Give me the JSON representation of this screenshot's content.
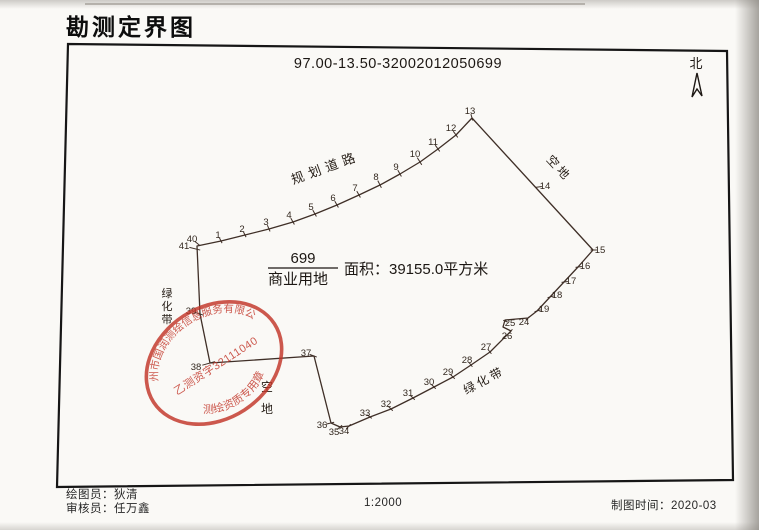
{
  "title": "勘测定界图",
  "map": {
    "code": "97.00-13.50-32002012050699",
    "north_label": "北",
    "parcel": {
      "number": "699",
      "land_use": "商业用地",
      "area_label": "面积：39155.0平方米"
    },
    "annotations": [
      {
        "name": "planned-road-label",
        "text": "规划道路",
        "x": 327,
        "y": 172,
        "rotate": -20,
        "spacing": 5,
        "size": 13
      },
      {
        "name": "vacant-land-label-right",
        "text": "空地",
        "x": 556,
        "y": 171,
        "rotate": 47,
        "spacing": 3,
        "size": 12
      },
      {
        "name": "green-belt-label-bottom",
        "text": "绿化带",
        "x": 486,
        "y": 384,
        "rotate": -28,
        "spacing": 3,
        "size": 12
      }
    ],
    "vertical_annotations": [
      {
        "name": "green-belt-label-left",
        "text": "绿化带",
        "x": 167,
        "y": 297,
        "dy": 13,
        "size": 11
      },
      {
        "name": "vacant-land-label-bottomleft",
        "text": "空地",
        "x": 267,
        "y": 391,
        "dy": 22,
        "size": 12
      }
    ],
    "outline": [
      [
        197,
        246
      ],
      [
        221,
        241
      ],
      [
        245,
        235
      ],
      [
        269,
        229
      ],
      [
        293,
        222
      ],
      [
        315,
        214
      ],
      [
        337,
        205
      ],
      [
        359,
        195
      ],
      [
        380,
        185
      ],
      [
        400,
        174
      ],
      [
        420,
        162
      ],
      [
        438,
        149
      ],
      [
        456,
        135
      ],
      [
        472,
        118
      ],
      [
        593,
        250
      ],
      [
        578,
        267
      ],
      [
        564,
        282
      ],
      [
        550,
        297
      ],
      [
        537,
        311
      ],
      [
        528,
        318
      ],
      [
        505,
        320
      ],
      [
        503,
        327
      ],
      [
        511,
        331
      ],
      [
        490,
        352
      ],
      [
        471,
        365
      ],
      [
        453,
        377
      ],
      [
        434,
        387
      ],
      [
        413,
        398
      ],
      [
        391,
        409
      ],
      [
        370,
        417
      ],
      [
        349,
        426
      ],
      [
        340,
        427
      ],
      [
        331,
        423
      ],
      [
        314,
        356
      ],
      [
        210,
        363
      ],
      [
        200,
        314
      ]
    ],
    "points": [
      {
        "n": "40",
        "vx": 198,
        "vy": 244,
        "lx": 192,
        "ly": 239
      },
      {
        "n": "41",
        "vx": 196,
        "vy": 249,
        "lx": 184,
        "ly": 246
      },
      {
        "n": "1",
        "vx": 221,
        "vy": 241,
        "lx": 218,
        "ly": 235
      },
      {
        "n": "2",
        "vx": 245,
        "vy": 235,
        "lx": 242,
        "ly": 229
      },
      {
        "n": "3",
        "vx": 269,
        "vy": 229,
        "lx": 266,
        "ly": 222
      },
      {
        "n": "4",
        "vx": 293,
        "vy": 222,
        "lx": 289,
        "ly": 215
      },
      {
        "n": "5",
        "vx": 315,
        "vy": 214,
        "lx": 311,
        "ly": 207
      },
      {
        "n": "6",
        "vx": 337,
        "vy": 205,
        "lx": 333,
        "ly": 198
      },
      {
        "n": "7",
        "vx": 359,
        "vy": 195,
        "lx": 355,
        "ly": 188
      },
      {
        "n": "8",
        "vx": 380,
        "vy": 185,
        "lx": 376,
        "ly": 177
      },
      {
        "n": "9",
        "vx": 400,
        "vy": 174,
        "lx": 396,
        "ly": 167
      },
      {
        "n": "10",
        "vx": 420,
        "vy": 162,
        "lx": 415,
        "ly": 154
      },
      {
        "n": "11",
        "vx": 438,
        "vy": 149,
        "lx": 433,
        "ly": 142
      },
      {
        "n": "12",
        "vx": 456,
        "vy": 135,
        "lx": 451,
        "ly": 128
      },
      {
        "n": "13",
        "vx": 472,
        "vy": 118,
        "lx": 470,
        "ly": 111
      },
      {
        "n": "14",
        "vx": 538,
        "vy": 187,
        "lx": 545,
        "ly": 186
      },
      {
        "n": "15",
        "vx": 593,
        "vy": 250,
        "lx": 600,
        "ly": 250
      },
      {
        "n": "16",
        "vx": 578,
        "vy": 267,
        "lx": 585,
        "ly": 266
      },
      {
        "n": "17",
        "vx": 564,
        "vy": 282,
        "lx": 571,
        "ly": 281
      },
      {
        "n": "18",
        "vx": 550,
        "vy": 297,
        "lx": 557,
        "ly": 295
      },
      {
        "n": "19",
        "vx": 537,
        "vy": 311,
        "lx": 544,
        "ly": 309
      },
      {
        "n": "24",
        "vx": 528,
        "vy": 318,
        "lx": 524,
        "ly": 322
      },
      {
        "n": "25",
        "vx": 505,
        "vy": 321,
        "lx": 510,
        "ly": 323
      },
      {
        "n": "26",
        "vx": 511,
        "vy": 331,
        "lx": 507,
        "ly": 336
      },
      {
        "n": "27",
        "vx": 490,
        "vy": 352,
        "lx": 486,
        "ly": 347
      },
      {
        "n": "28",
        "vx": 471,
        "vy": 365,
        "lx": 467,
        "ly": 360
      },
      {
        "n": "29",
        "vx": 453,
        "vy": 377,
        "lx": 448,
        "ly": 372
      },
      {
        "n": "30",
        "vx": 434,
        "vy": 387,
        "lx": 429,
        "ly": 382
      },
      {
        "n": "31",
        "vx": 413,
        "vy": 398,
        "lx": 408,
        "ly": 393
      },
      {
        "n": "32",
        "vx": 391,
        "vy": 409,
        "lx": 386,
        "ly": 404
      },
      {
        "n": "33",
        "vx": 370,
        "vy": 417,
        "lx": 365,
        "ly": 413
      },
      {
        "n": "34",
        "vx": 349,
        "vy": 426,
        "lx": 344,
        "ly": 431
      },
      {
        "n": "35",
        "vx": 340,
        "vy": 427,
        "lx": 334,
        "ly": 432
      },
      {
        "n": "36",
        "vx": 331,
        "vy": 423,
        "lx": 322,
        "ly": 425
      },
      {
        "n": "37",
        "vx": 314,
        "vy": 356,
        "lx": 306,
        "ly": 353
      },
      {
        "n": "38",
        "vx": 210,
        "vy": 363,
        "lx": 196,
        "ly": 367
      },
      {
        "n": "39",
        "vx": 200,
        "vy": 314,
        "lx": 191,
        "ly": 311
      }
    ],
    "line_color": "#3f2f27",
    "label_color": "#33281f"
  },
  "stamp": {
    "line1": "徐州市国润测绘信息服务有限公司",
    "line2": "乙测资字32111040",
    "line3": "测绘资质专用章",
    "color": "#c23528"
  },
  "footer": {
    "drafter": "绘图员：狄清",
    "reviewer": "审核员：任万鑫",
    "scale": "1:2000",
    "date": "制图时间：2020-03"
  }
}
